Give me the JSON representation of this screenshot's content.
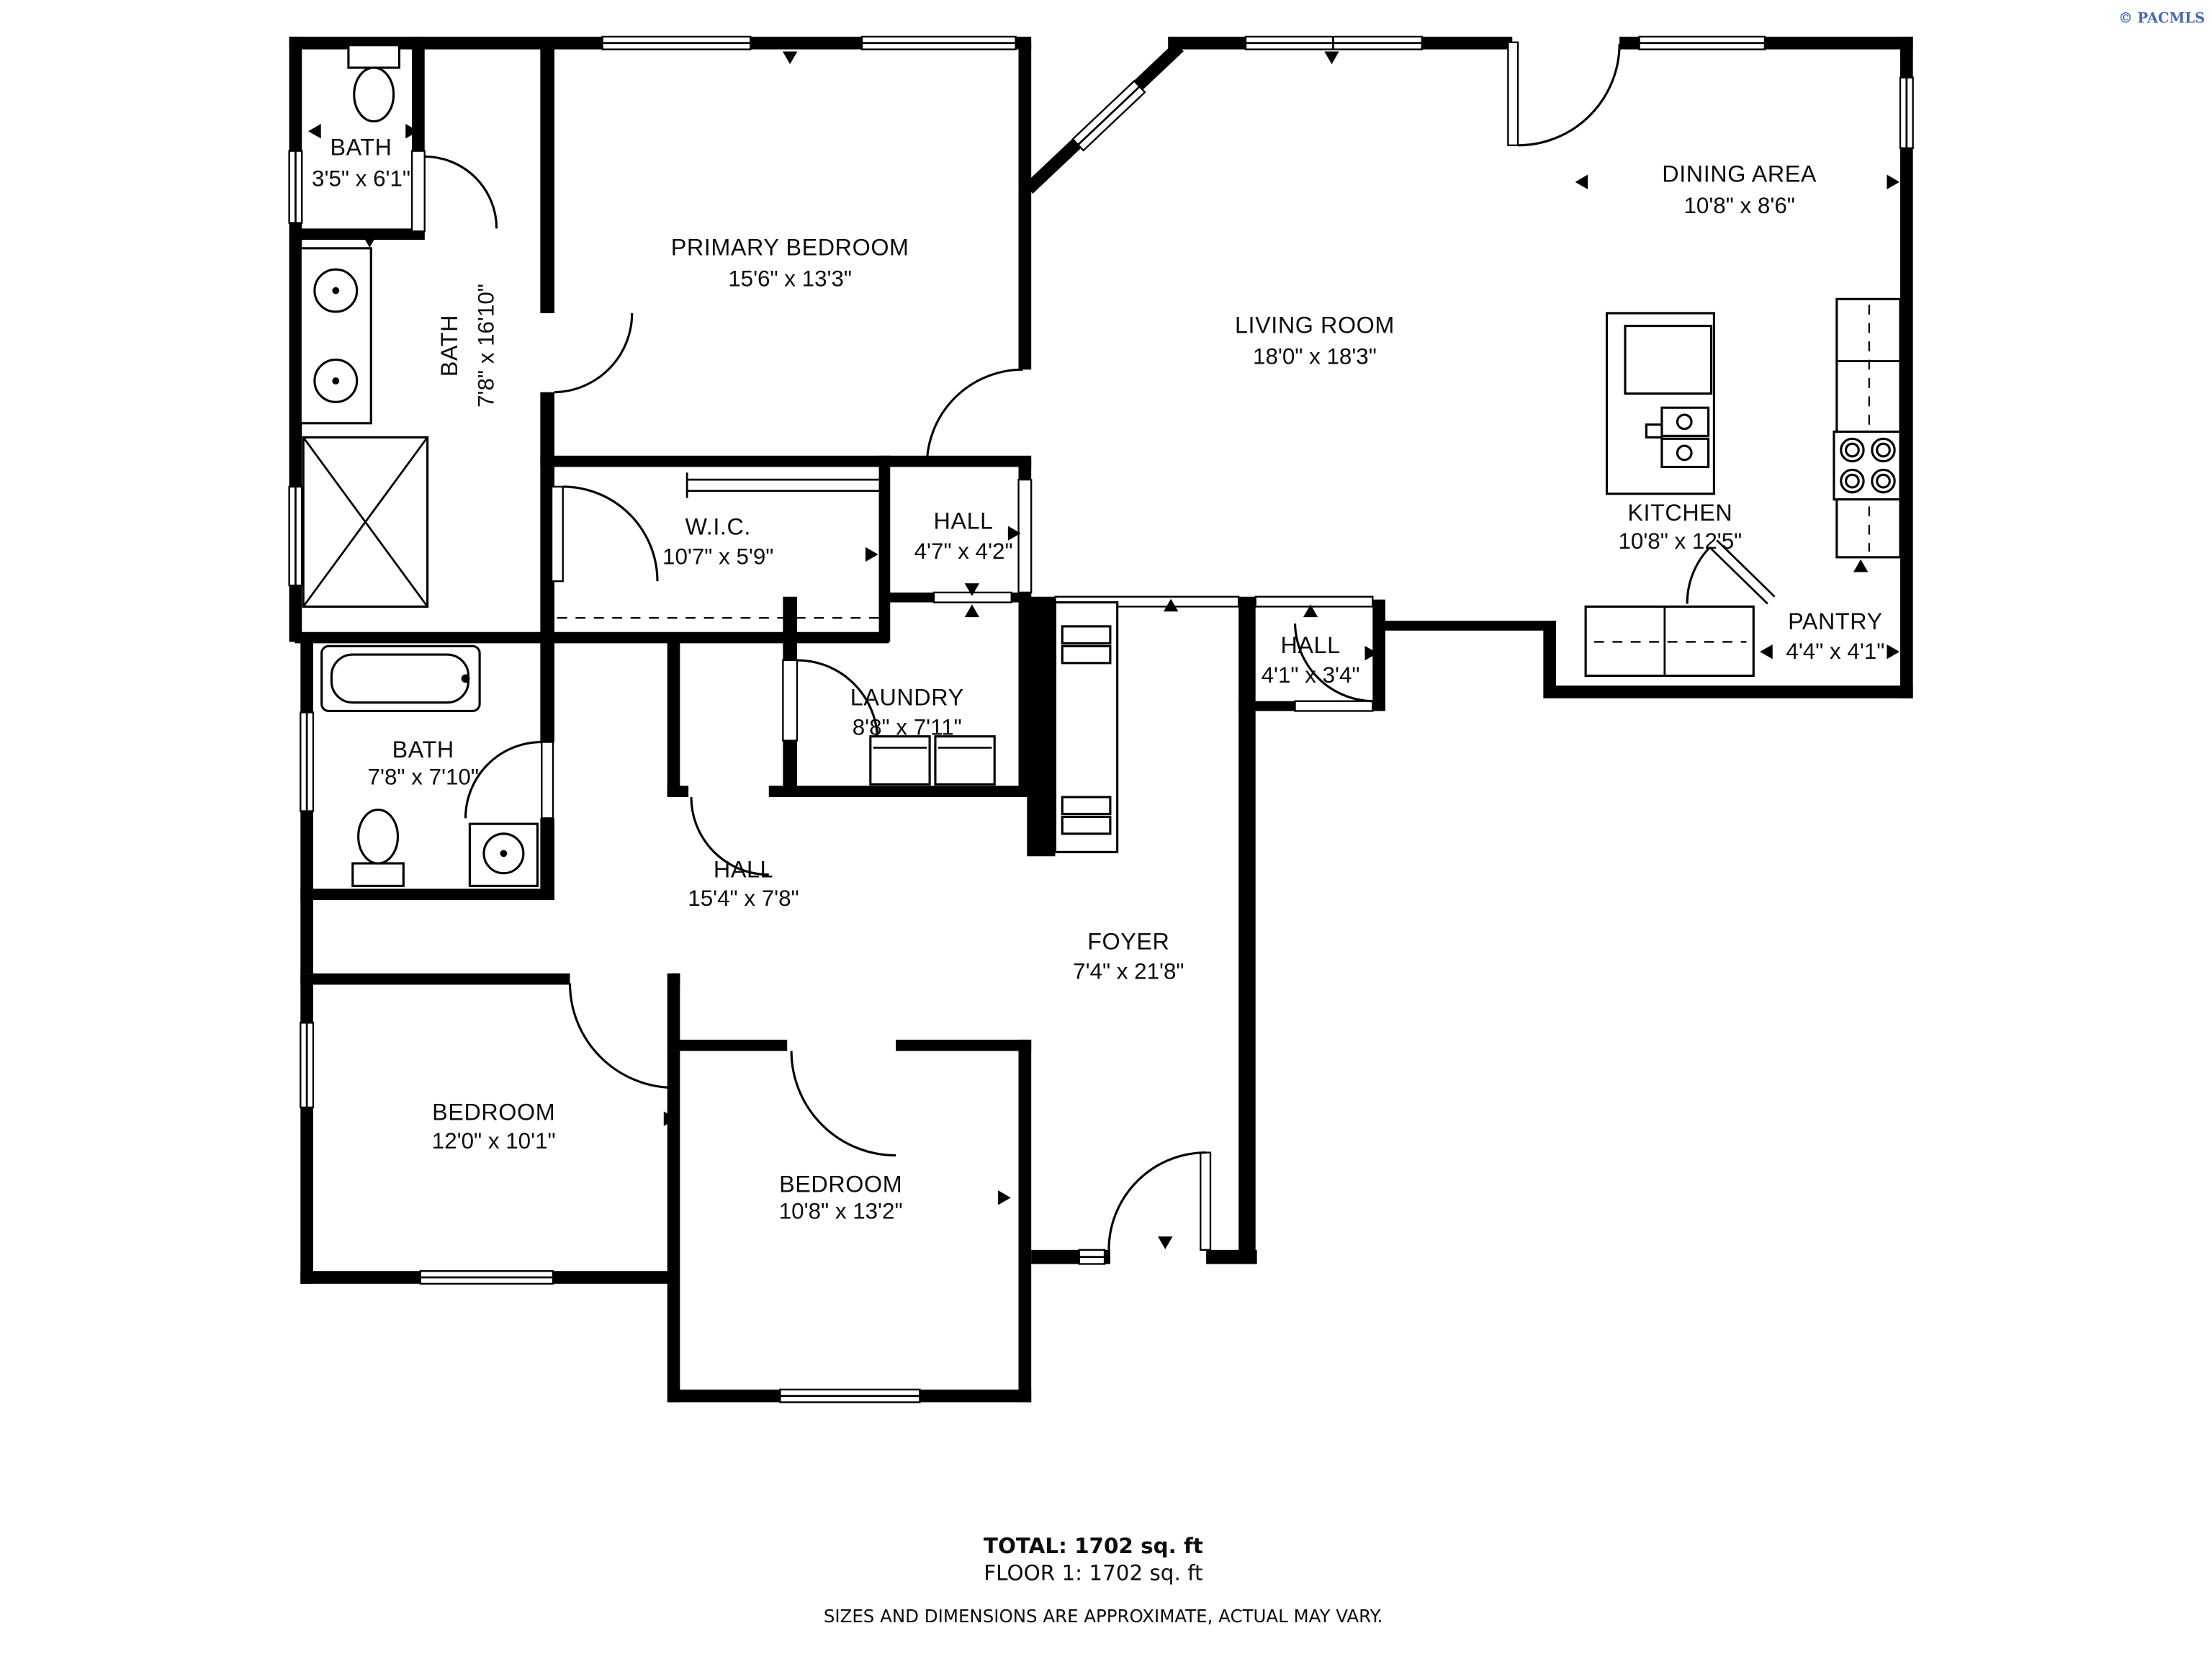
{
  "meta": {
    "title": "Floor plan",
    "copyright": "© PACMLS",
    "copyright_color": "#4a68ae",
    "wall_color": "#000000",
    "background_color": "#ffffff"
  },
  "rooms": [
    {
      "name": "BATH",
      "dims": "3'5\" x 6'1\""
    },
    {
      "name": "BATH",
      "dims": "7'8\" x 16'10\""
    },
    {
      "name": "PRIMARY BEDROOM",
      "dims": "15'6\" x 13'3\""
    },
    {
      "name": "DINING AREA",
      "dims": "10'8\" x 8'6\""
    },
    {
      "name": "LIVING ROOM",
      "dims": "18'0\" x 18'3\""
    },
    {
      "name": "KITCHEN",
      "dims": "10'8\" x 12'5\""
    },
    {
      "name": "W.I.C.",
      "dims": "10'7\" x 5'9\""
    },
    {
      "name": "HALL",
      "dims": "4'7\" x 4'2\""
    },
    {
      "name": "PANTRY",
      "dims": "4'4\" x 4'1\""
    },
    {
      "name": "HALL",
      "dims": "4'1\" x 3'4\""
    },
    {
      "name": "LAUNDRY",
      "dims": "8'8\" x 7'11\""
    },
    {
      "name": "BATH",
      "dims": "7'8\" x 7'10\""
    },
    {
      "name": "HALL",
      "dims": "15'4\" x 7'8\""
    },
    {
      "name": "FOYER",
      "dims": "7'4\" x 21'8\""
    },
    {
      "name": "BEDROOM",
      "dims": "12'0\" x 10'1\""
    },
    {
      "name": "BEDROOM",
      "dims": "10'8\" x 13'2\""
    }
  ],
  "footer": {
    "total": "TOTAL: 1702 sq. ft",
    "floor": "FLOOR 1: 1702 sq. ft",
    "disclaimer": "SIZES AND DIMENSIONS ARE APPROXIMATE, ACTUAL MAY VARY."
  }
}
